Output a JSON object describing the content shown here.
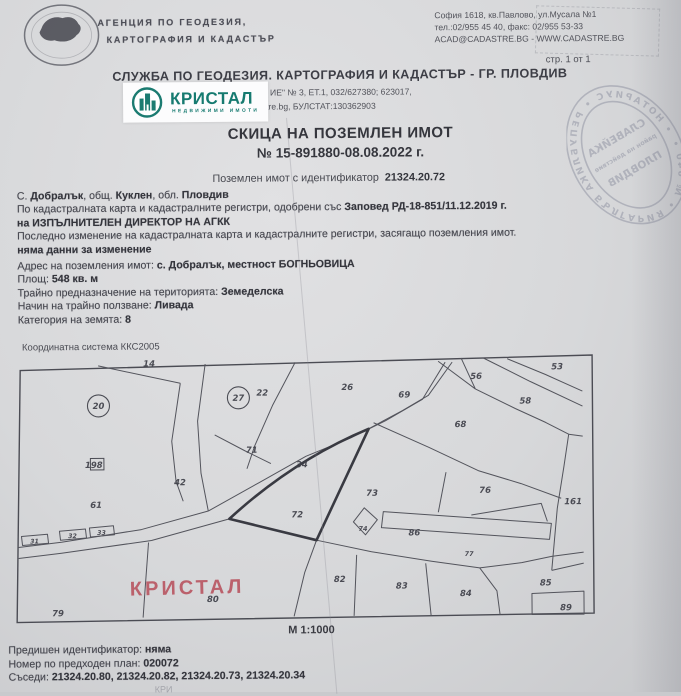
{
  "header": {
    "agency_line1": "АГЕНЦИЯ ПО ГЕОДЕЗИЯ,",
    "agency_line2": "КАРТОГРАФИЯ И КАДАСТЪР",
    "addr1": "София 1618, кв.Павлово, ул.Мусала №1",
    "addr2": "тел.:02/955 45 40, факс: 02/955 53-33",
    "addr3": "ACAD@CADASTRE.BG - WWW.CADASTRE.BG",
    "page_number": "стр. 1 от 1",
    "office_title": "СЛУЖБА ПО ГЕОДЕЗИЯ. КАРТОГРАФИЯ И КАДАСТЪР - ГР. ПЛОВДИВ",
    "office_addr_fragment1": "ИЕ\" № 3, ЕТ.1, 032/627380; 623017,",
    "office_addr_fragment2": "tre.bg, БУЛСТАТ:130362903"
  },
  "kristal": {
    "name": "КРИСТАЛ",
    "tagline": "НЕДВИЖИМИ ИМОТИ",
    "teal": "#167a70"
  },
  "stamp": {
    "ring": "• НОТАРИУС • РЕПУБЛИКА БЪЛГАРИЯ • № 640 •",
    "c1": "СЛАВЕЙКА",
    "c2": "район на действие",
    "c3": "ПЛОВДИВ"
  },
  "doc": {
    "title1": "СКИЦА НА ПОЗЕМЛЕН ИМОТ",
    "title2": "№ 15-891880-08.08.2022 г.",
    "id_label": "Поземлен имот с идентификатор",
    "id_value": "21324.20.72"
  },
  "info": {
    "loc_p1": "С. ",
    "loc_b1": "Добралък",
    "loc_p2": ", общ. ",
    "loc_b2": "Куклен",
    "loc_p3": ", обл. ",
    "loc_b3": "Пловдив",
    "approved_pre": "По кадастралната карта и кадастралните регистри, одобрени със ",
    "approved_bold": "Заповед РД-18-851/11.12.2019 г.",
    "director": "на ИЗПЪЛНИТЕЛЕН ДИРЕКТОР НА АГКК",
    "lastchange": "Последно изменение на кадастралната карта и кадастралните регистри, засягащо поземления имот.",
    "nochange": "няма данни за изменение",
    "addr_pre": "Адрес на поземления имот: ",
    "addr_bold": "с. Добралък, местност БОГНЬОВИЦА",
    "area_pre": "Площ: ",
    "area_bold": "548 кв. м",
    "purpose_pre": "Трайно предназначение на територията: ",
    "purpose_bold": "Земеделска",
    "use_pre": "Начин на трайно ползване: ",
    "use_bold": "Ливада",
    "cat_pre": "Категория на земята: ",
    "cat_bold": "8"
  },
  "map": {
    "coord_system": "Координатна система ККС2005",
    "scale": "М 1:1000",
    "watermark": "КРИСТАЛ",
    "target_parcel": "72",
    "labels": [
      {
        "t": "14",
        "x": 143,
        "y": 15
      },
      {
        "t": "20",
        "x": 98,
        "y": 54,
        "s": "circle"
      },
      {
        "t": "27",
        "x": 238,
        "y": 47,
        "s": "circle"
      },
      {
        "t": "22",
        "x": 256,
        "y": 45
      },
      {
        "t": "26",
        "x": 341,
        "y": 40
      },
      {
        "t": "69",
        "x": 398,
        "y": 48
      },
      {
        "t": "56",
        "x": 470,
        "y": 30
      },
      {
        "t": "53",
        "x": 551,
        "y": 21
      },
      {
        "t": "58",
        "x": 519,
        "y": 55
      },
      {
        "t": "68",
        "x": 454,
        "y": 78
      },
      {
        "t": "71",
        "x": 245,
        "y": 102
      },
      {
        "t": "198",
        "x": 84,
        "y": 116,
        "s": "box"
      },
      {
        "t": "42",
        "x": 173,
        "y": 134
      },
      {
        "t": "34",
        "x": 295,
        "y": 117
      },
      {
        "t": "61",
        "x": 89,
        "y": 156
      },
      {
        "t": "72",
        "x": 290,
        "y": 167
      },
      {
        "t": "73",
        "x": 365,
        "y": 146
      },
      {
        "t": "76",
        "x": 478,
        "y": 144
      },
      {
        "t": "161",
        "x": 563,
        "y": 156
      },
      {
        "t": "74",
        "x": 357,
        "y": 181,
        "s": "small"
      },
      {
        "t": "86",
        "x": 407,
        "y": 186
      },
      {
        "t": "77",
        "x": 463,
        "y": 207,
        "s": "small"
      },
      {
        "t": "31",
        "x": 33,
        "y": 191,
        "s": "bldg"
      },
      {
        "t": "32",
        "x": 71,
        "y": 186,
        "s": "bldg"
      },
      {
        "t": "33",
        "x": 100,
        "y": 183,
        "s": "bldg"
      },
      {
        "t": "82",
        "x": 332,
        "y": 232
      },
      {
        "t": "83",
        "x": 394,
        "y": 239
      },
      {
        "t": "84",
        "x": 458,
        "y": 247
      },
      {
        "t": "85",
        "x": 538,
        "y": 237
      },
      {
        "t": "89",
        "x": 558,
        "y": 262
      },
      {
        "t": "79",
        "x": 50,
        "y": 264
      },
      {
        "t": "80",
        "x": 205,
        "y": 251
      }
    ]
  },
  "footer": {
    "prev_pre": "Предишен идентификатор: ",
    "prev_bold": "няма",
    "plan_pre": "Номер по предходен план: ",
    "plan_bold": "020072",
    "neigh_pre": "Съседи: ",
    "neigh_bold": "21324.20.80, 21324.20.82, 21324.20.73, 21324.20.34",
    "cut_fragment": "КРИ"
  }
}
